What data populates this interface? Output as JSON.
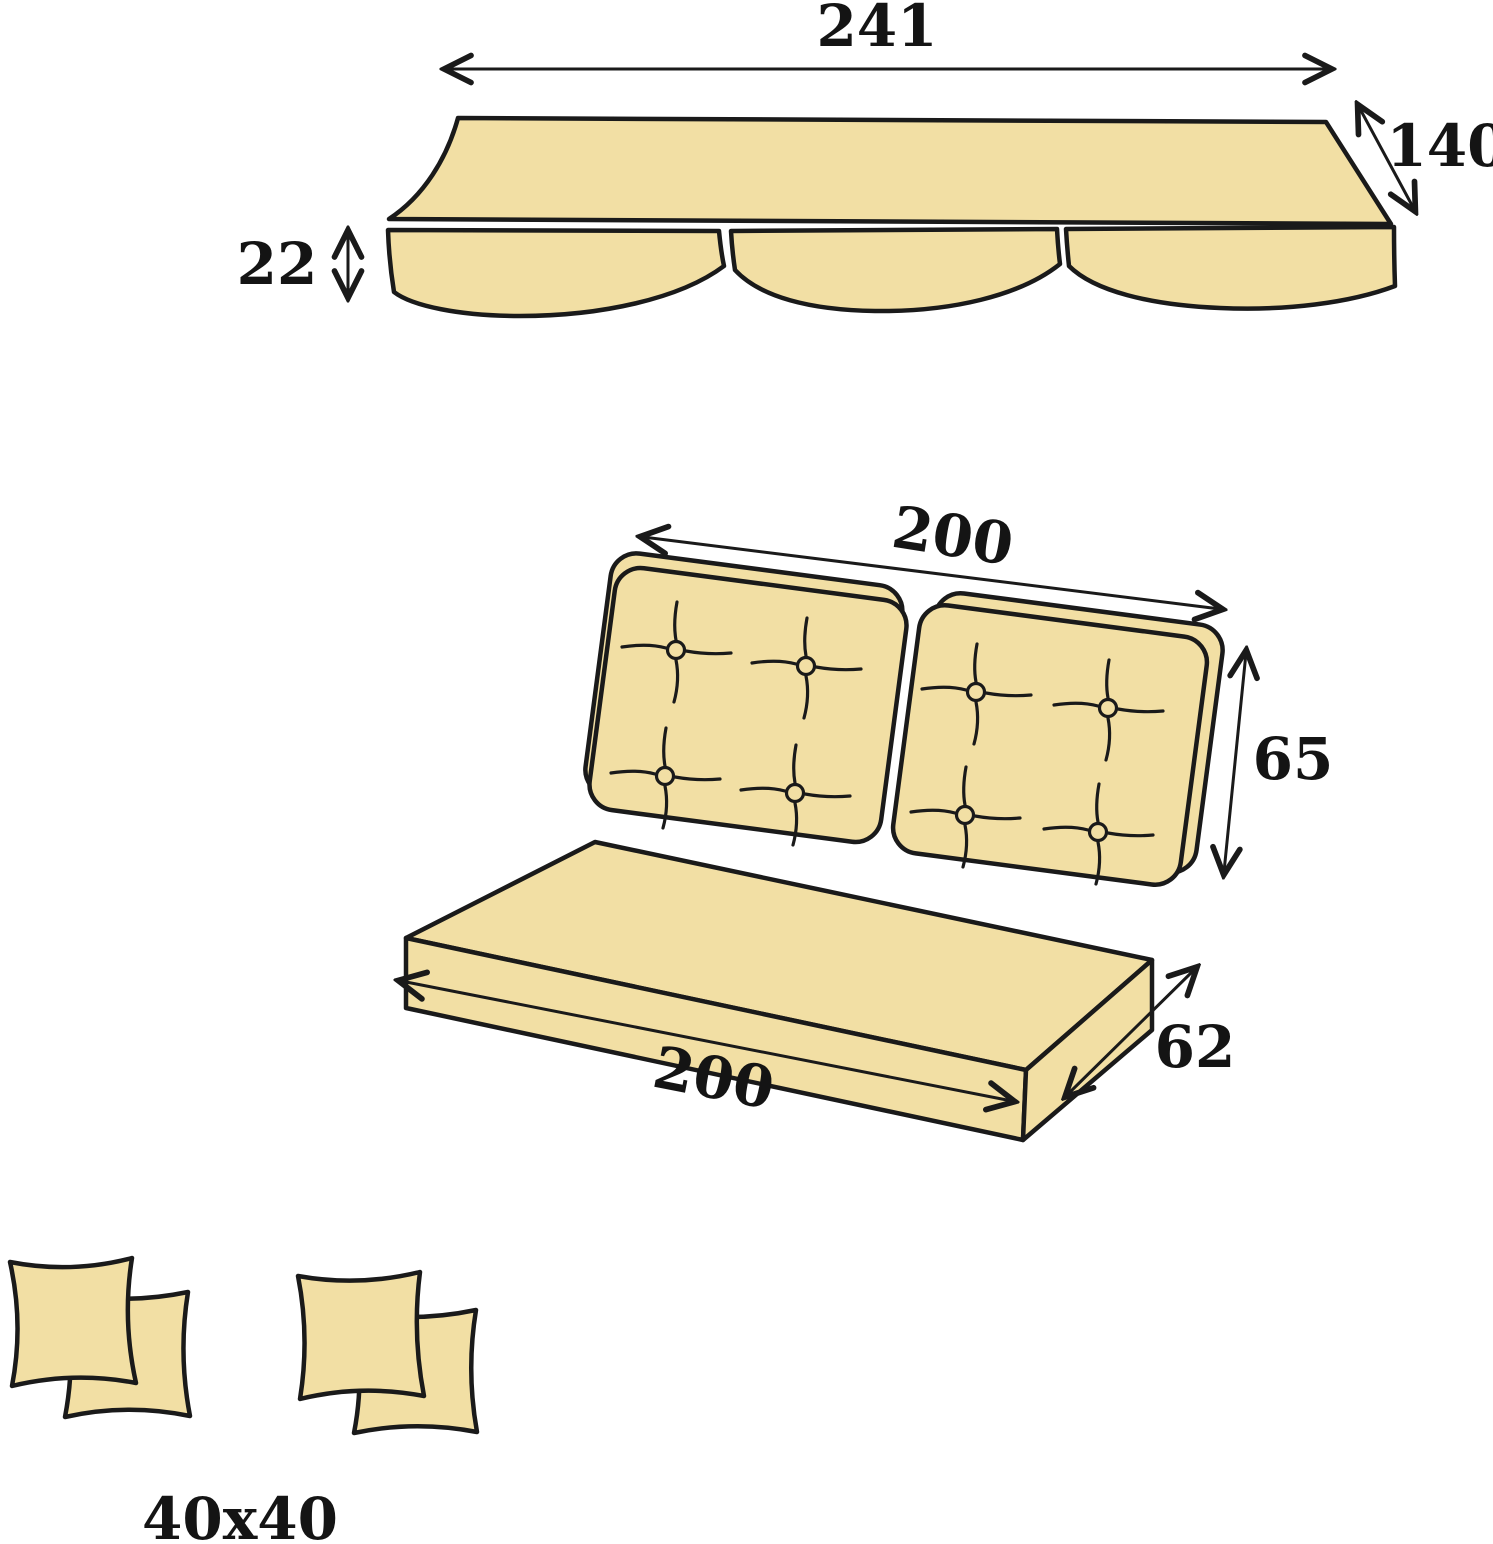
{
  "colors": {
    "background": "#FFFFFF",
    "cushion_fill": "#F2DFA4",
    "outline": "#1A1A1A",
    "label_text": "#141414"
  },
  "diagram": {
    "subject": "Swing canopy and cushion set dimension drawing",
    "parts": {
      "canopy": {
        "width_label": "241",
        "depth_label": "140",
        "valance_drop_label": "22"
      },
      "bench": {
        "backrest_width_label": "200",
        "backrest_height_label": "65",
        "seat_length_label": "200",
        "seat_depth_label": "62"
      },
      "pillows": {
        "size_label": "40x40"
      }
    }
  }
}
